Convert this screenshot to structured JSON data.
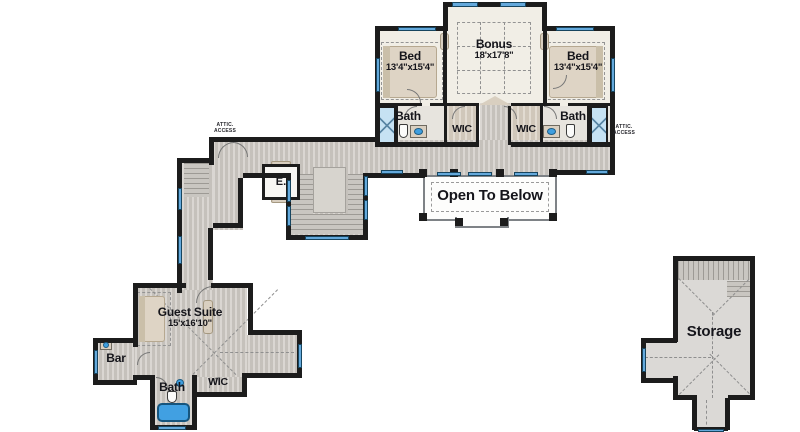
{
  "labels": {
    "bed_left": {
      "name": "Bed",
      "dims": "13'4\"x15'4\""
    },
    "bed_right": {
      "name": "Bed",
      "dims": "13'4\"x15'4\""
    },
    "bonus": {
      "name": "Bonus",
      "dims": "18'x17'8\""
    },
    "bath_left": "Bath",
    "bath_right": "Bath",
    "wic_left": "WIC",
    "wic_right": "WIC",
    "attic_left": {
      "line1": "ATTIC.",
      "line2": "ACCESS"
    },
    "attic_right": {
      "line1": "ATTIC.",
      "line2": "ACCESS"
    },
    "open_to_below": "Open To Below",
    "elevator": "E.",
    "guest_suite": {
      "name": "Guest Suite",
      "dims": "15'x16'10\""
    },
    "bar": "Bar",
    "bath_guest": "Bath",
    "wic_guest": "WIC",
    "storage": "Storage"
  },
  "colors": {
    "wall": "#1c1c1c",
    "floor_wood": "#cdc9c3",
    "floor_cream": "#f1eee6",
    "floor_bath": "#e7e4de",
    "floor_wic": "#d8cfc2",
    "floor_storage": "#dbd9d6",
    "window_blue": "#64a9dc",
    "fixture_blue": "#3f9fe0",
    "furniture_tan": "#d9cfc0",
    "dash_gray": "#8f8f8f",
    "label_text": "#15151b"
  }
}
